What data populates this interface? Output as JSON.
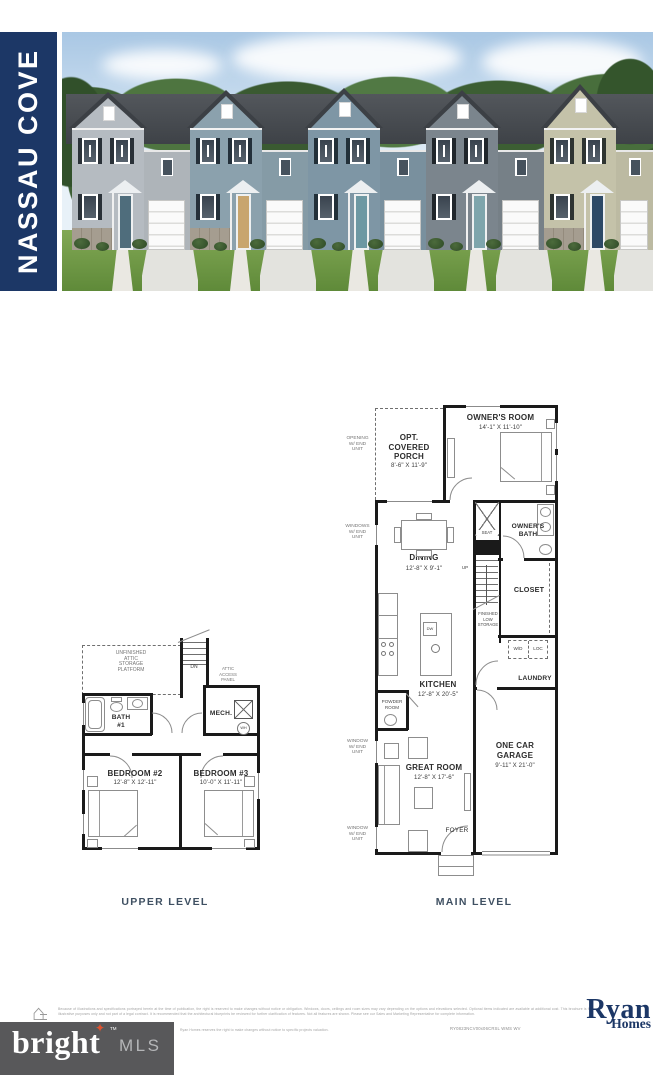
{
  "header": {
    "community_name": "NASSAU COVE"
  },
  "photo": {
    "description": "row of five two-story townhomes",
    "houses": [
      {
        "siding": "#b5bbc1",
        "door": "#4f6d7c",
        "shutters": "#2a3138",
        "stone": true
      },
      {
        "siding": "#8ba1ad",
        "door": "#c8a56e",
        "shutters": "#24303a",
        "stone": true
      },
      {
        "siding": "#7e96a5",
        "door": "#6d98a3",
        "shutters": "#223039",
        "stone": false
      },
      {
        "siding": "#7b858d",
        "door": "#7ea5ac",
        "shutters": "#20262b",
        "stone": false
      },
      {
        "siding": "#c4c2a9",
        "door": "#2d4966",
        "shutters": "#2e3431",
        "stone": true
      }
    ]
  },
  "floorplans": {
    "upper": {
      "caption": "UPPER LEVEL",
      "labels": {
        "attic": "UNFINISHED\nATTIC\nSTORAGE\nPLATFORM",
        "dn": "DN",
        "attic_access": "ATTIC\nACCESS\nPANEL",
        "bath1": "BATH\n#1",
        "mech": "MECH.",
        "wh": "WH",
        "bedroom2": "BEDROOM #2",
        "bedroom2_dims": "12'-8\" X 12'-11\"",
        "bedroom3": "BEDROOM #3",
        "bedroom3_dims": "10'-0\" X 11'-11\""
      }
    },
    "main": {
      "caption": "MAIN LEVEL",
      "labels": {
        "opening_note": "OPENING\nW/ END\nUNIT",
        "windows_note": "WINDOWS\nW/ END\nUNIT",
        "window_note": "WINDOW\nW/ END\nUNIT",
        "porch": "OPT.\nCOVERED\nPORCH",
        "porch_dims": "8'-6\" X 11'-9\"",
        "owners_room": "OWNER'S ROOM",
        "owners_room_dims": "14'-1\" X 11'-10\"",
        "dining": "DINING",
        "dining_dims": "12'-8\" X 9'-1\"",
        "seat": "SEAT",
        "owners_bath": "OWNER'S\nBATH",
        "up": "UP",
        "closet": "CLOSET",
        "storage": "FINISHED\nLOW\nSTORAGE",
        "wd": "W/D",
        "loc": "LOC",
        "laundry": "LAUNDRY",
        "kitchen": "KITCHEN",
        "kitchen_dims": "12'-8\" X 20'-5\"",
        "dw": "DW",
        "powder": "POWDER\nROOM",
        "garage": "ONE CAR\nGARAGE",
        "garage_dims": "9'-11\" X 21'-0\"",
        "great_room": "GREAT ROOM",
        "great_room_dims": "12'-8\" X 17'-6\"",
        "foyer": "FOYER"
      }
    }
  },
  "footer": {
    "disclaimer": "Because of illustrations and specifications portrayed herein at the time of publication, the right is reserved to make changes without notice or obligation. Windows, doors, ceilings and room sizes may vary depending on the options and elevations selected. Optional items indicated are available at additional cost. This brochure is for illustrative purposes only and not part of a legal contract. It is recommended that the architectural blueprints be reviewed for further clarification of features. Not all features are shown. Please see our Sales and Marketing Representative for complete information.",
    "disclaimer2": "Ryan Homes reserves the right to make changes without notice to specific projects valuation.",
    "plan_code": "RY0823NCV00x06CRSL WMS WV",
    "builder_logo": {
      "line1": "Ryan",
      "line2": "Homes"
    },
    "watermark": {
      "brand": "bright",
      "tm": "TM",
      "suffix": "MLS"
    }
  },
  "colors": {
    "navy": "#1c3766",
    "caption_text": "#3f5062",
    "wall": "#1a1a1a",
    "watermark_bg": "#58585a",
    "watermark_star": "#e0532f",
    "grass": "#76a04a",
    "roof": "#42464b"
  }
}
